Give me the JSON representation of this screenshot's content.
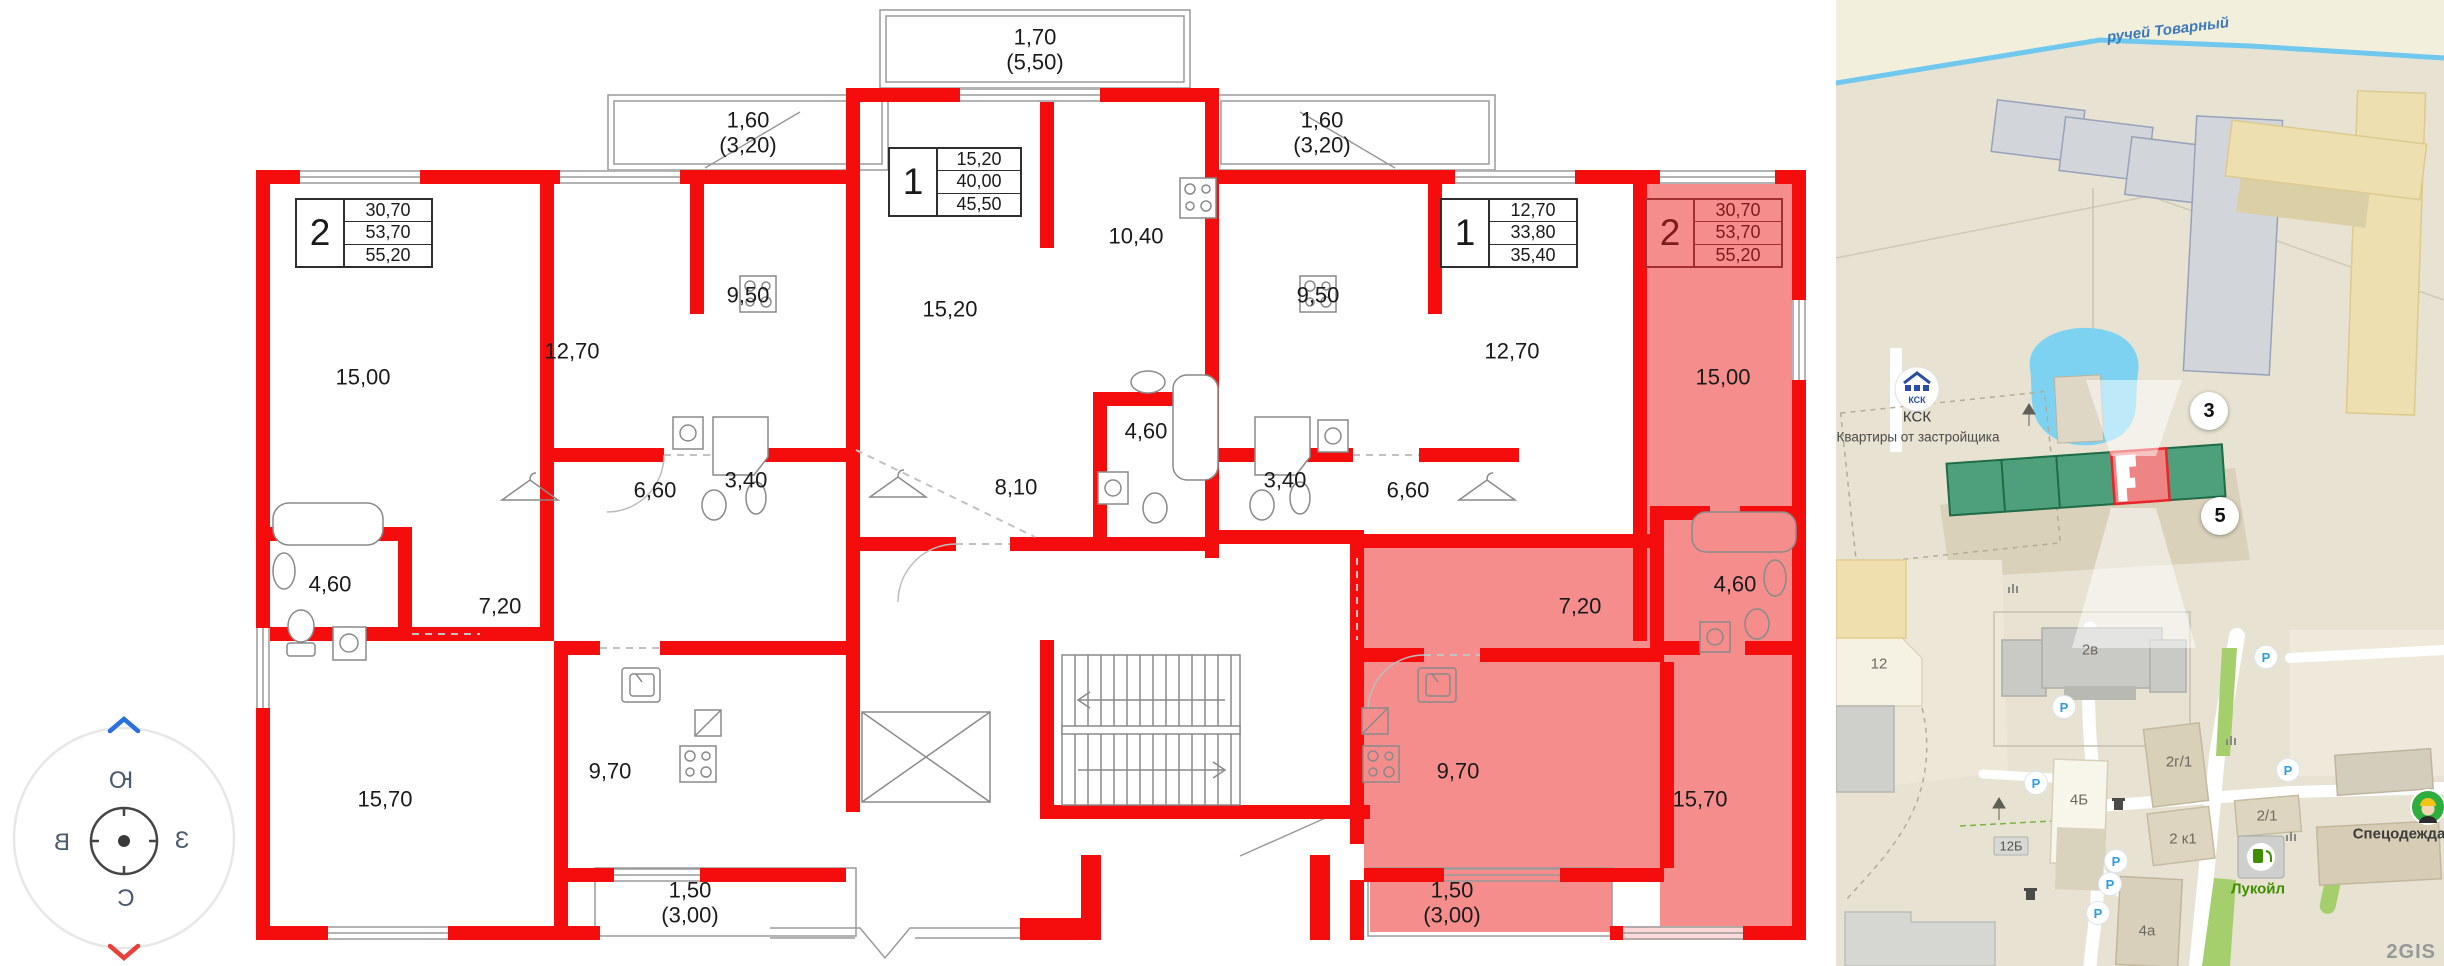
{
  "compass": {
    "top": "Ю",
    "left": "В",
    "right": "З",
    "bottom": "С"
  },
  "plan": {
    "wall_color": "#f50d0d",
    "highlight_color": "#f58d8d",
    "info_boxes": [
      {
        "num": "2",
        "a1": "30,70",
        "a2": "53,70",
        "a3": "55,20",
        "x": 295,
        "y": 198,
        "hl": false
      },
      {
        "num": "1",
        "a1": "15,20",
        "a2": "40,00",
        "a3": "45,50",
        "x": 888,
        "y": 147,
        "hl": false
      },
      {
        "num": "1",
        "a1": "12,70",
        "a2": "33,80",
        "a3": "35,40",
        "x": 1440,
        "y": 198,
        "hl": false
      },
      {
        "num": "2",
        "a1": "30,70",
        "a2": "53,70",
        "a3": "55,20",
        "x": 1645,
        "y": 198,
        "hl": true
      }
    ],
    "room_labels": [
      {
        "t": "15,00",
        "x": 363,
        "y": 378
      },
      {
        "t": "12,70",
        "x": 572,
        "y": 352
      },
      {
        "t": "9,50",
        "x": 748,
        "y": 296
      },
      {
        "t": "6,60",
        "x": 655,
        "y": 491
      },
      {
        "t": "3,40",
        "x": 746,
        "y": 481
      },
      {
        "t": "4,60",
        "x": 330,
        "y": 585
      },
      {
        "t": "7,20",
        "x": 500,
        "y": 607
      },
      {
        "t": "15,70",
        "x": 385,
        "y": 800
      },
      {
        "t": "9,70",
        "x": 610,
        "y": 772
      },
      {
        "t": "1,50\n(3,00)",
        "x": 690,
        "y": 903
      },
      {
        "t": "1,60\n(3,20)",
        "x": 748,
        "y": 133
      },
      {
        "t": "1,70\n(5,50)",
        "x": 1035,
        "y": 50
      },
      {
        "t": "1,60\n(3,20)",
        "x": 1322,
        "y": 133
      },
      {
        "t": "15,20",
        "x": 950,
        "y": 310
      },
      {
        "t": "10,40",
        "x": 1136,
        "y": 237
      },
      {
        "t": "4,60",
        "x": 1146,
        "y": 432
      },
      {
        "t": "8,10",
        "x": 1016,
        "y": 488
      },
      {
        "t": "9,50",
        "x": 1318,
        "y": 296
      },
      {
        "t": "12,70",
        "x": 1512,
        "y": 352
      },
      {
        "t": "6,60",
        "x": 1408,
        "y": 491
      },
      {
        "t": "3,40",
        "x": 1285,
        "y": 481
      },
      {
        "t": "15,00",
        "x": 1723,
        "y": 378
      },
      {
        "t": "4,60",
        "x": 1735,
        "y": 585
      },
      {
        "t": "7,20",
        "x": 1580,
        "y": 607
      },
      {
        "t": "9,70",
        "x": 1458,
        "y": 772
      },
      {
        "t": "15,70",
        "x": 1700,
        "y": 800
      },
      {
        "t": "1,50\n(3,00)",
        "x": 1452,
        "y": 903
      }
    ]
  },
  "map": {
    "stream": "ручей Товарный",
    "logo_text": "КСК",
    "developer_name": "КСК",
    "developer_sub": "Квартиры от застройщика",
    "watermark": "2GIS",
    "parking_letter": "P",
    "badges": [
      {
        "t": "3",
        "x": 2209,
        "y": 411
      },
      {
        "t": "5",
        "x": 2220,
        "y": 516
      }
    ],
    "labels": [
      {
        "t": "12",
        "x": 1879,
        "y": 664,
        "s": "bldg"
      },
      {
        "t": "2в",
        "x": 2090,
        "y": 650,
        "s": "bldg"
      },
      {
        "t": "2г/1",
        "x": 2179,
        "y": 762,
        "s": "bldg"
      },
      {
        "t": "12Б",
        "x": 2011,
        "y": 846,
        "s": "boxed"
      },
      {
        "t": "4Б",
        "x": 2079,
        "y": 800,
        "s": "bldg"
      },
      {
        "t": "2 к1",
        "x": 2183,
        "y": 839,
        "s": "bldg"
      },
      {
        "t": "2/1",
        "x": 2267,
        "y": 816,
        "s": "bldg"
      },
      {
        "t": "4а",
        "x": 2147,
        "y": 931,
        "s": "bldg"
      }
    ],
    "pois": [
      {
        "t": "Лукойл",
        "x": 2258,
        "y": 889,
        "c": "#3f8e00"
      },
      {
        "t": "Спецодежда",
        "x": 2399,
        "y": 834,
        "c": "#3b3b3b"
      }
    ],
    "parking": [
      {
        "x": 2064,
        "y": 707
      },
      {
        "x": 2266,
        "y": 657
      },
      {
        "x": 2036,
        "y": 783
      },
      {
        "x": 2116,
        "y": 861
      },
      {
        "x": 2110,
        "y": 884
      },
      {
        "x": 2098,
        "y": 913
      },
      {
        "x": 2288,
        "y": 770
      }
    ],
    "colors": {
      "map_bg": "#e7e2d2",
      "pond": "#7dd2f2",
      "stream": "#70c8ee",
      "green_building": "#4ea07c",
      "selected_section": "#ef8484",
      "selected_border": "#e9252b",
      "gray_building": "#d2d5d9",
      "tan_building": "#eedfb0"
    }
  }
}
